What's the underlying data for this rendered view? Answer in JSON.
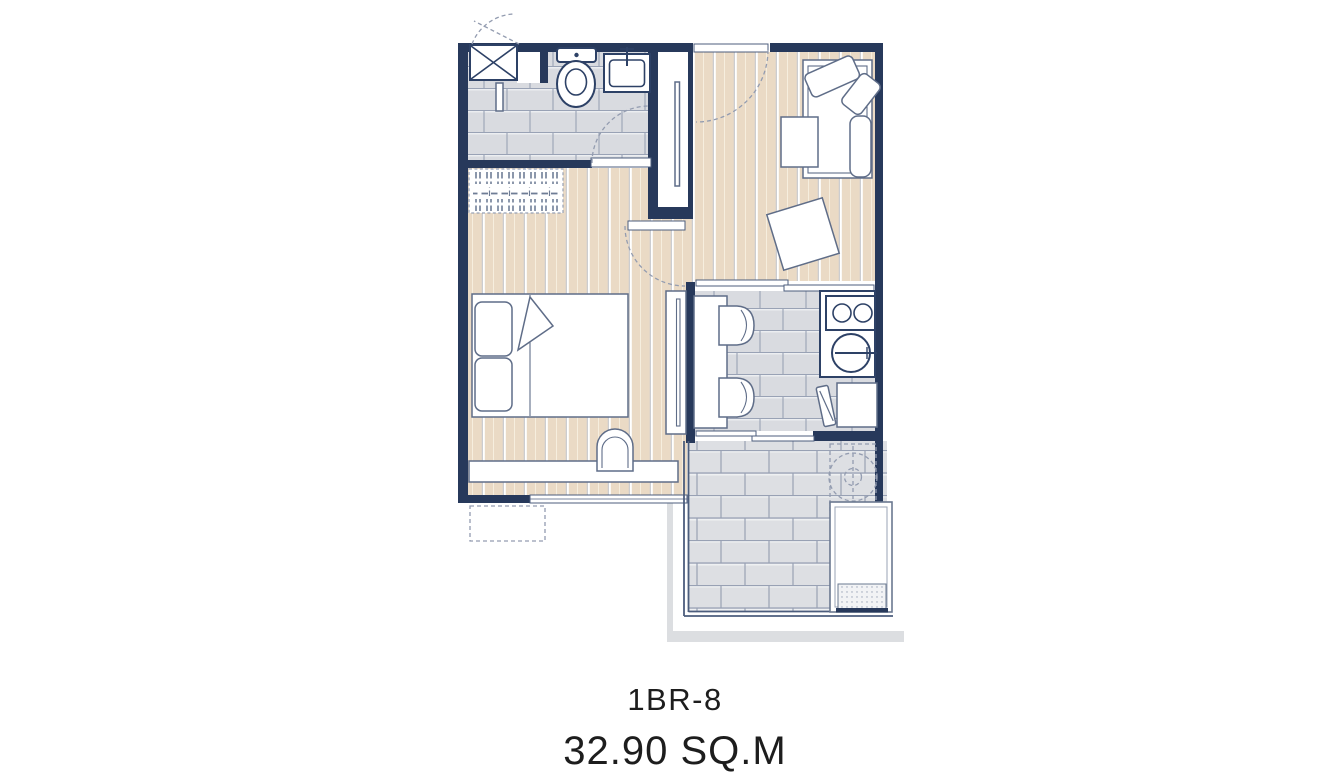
{
  "plan": {
    "unit_label": "1BR-8",
    "area_label": "32.90 SQ.M",
    "colors": {
      "wall": "#27395b",
      "wood_floor": "#eadac5",
      "tile_fill": "#d9dbe0",
      "tile_joint": "#9aa3b6",
      "fixture_stroke": "#2d4166",
      "furniture_stroke": "#5f6d88",
      "shadow": "#dcdee1",
      "text": "#1d1d1d"
    },
    "fixtures": [
      "washer-closet-icon",
      "shower-partition-icon",
      "toilet-icon",
      "bathroom-sink-icon",
      "hanging-clothes-icon",
      "bed-icon",
      "pillow-icon",
      "desk-console-icon",
      "desk-chair-icon",
      "wardrobe-icon",
      "sliding-door-icon",
      "entrance-door-icon",
      "sofa-icon",
      "coffee-table-icon",
      "side-table-icon",
      "bar-counter-icon",
      "bar-stool-icon",
      "stove-icon",
      "kitchen-sink-icon",
      "dining-table-icon",
      "dining-chair-icon",
      "balcony-washer-icon",
      "ac-ledge-icon"
    ]
  }
}
